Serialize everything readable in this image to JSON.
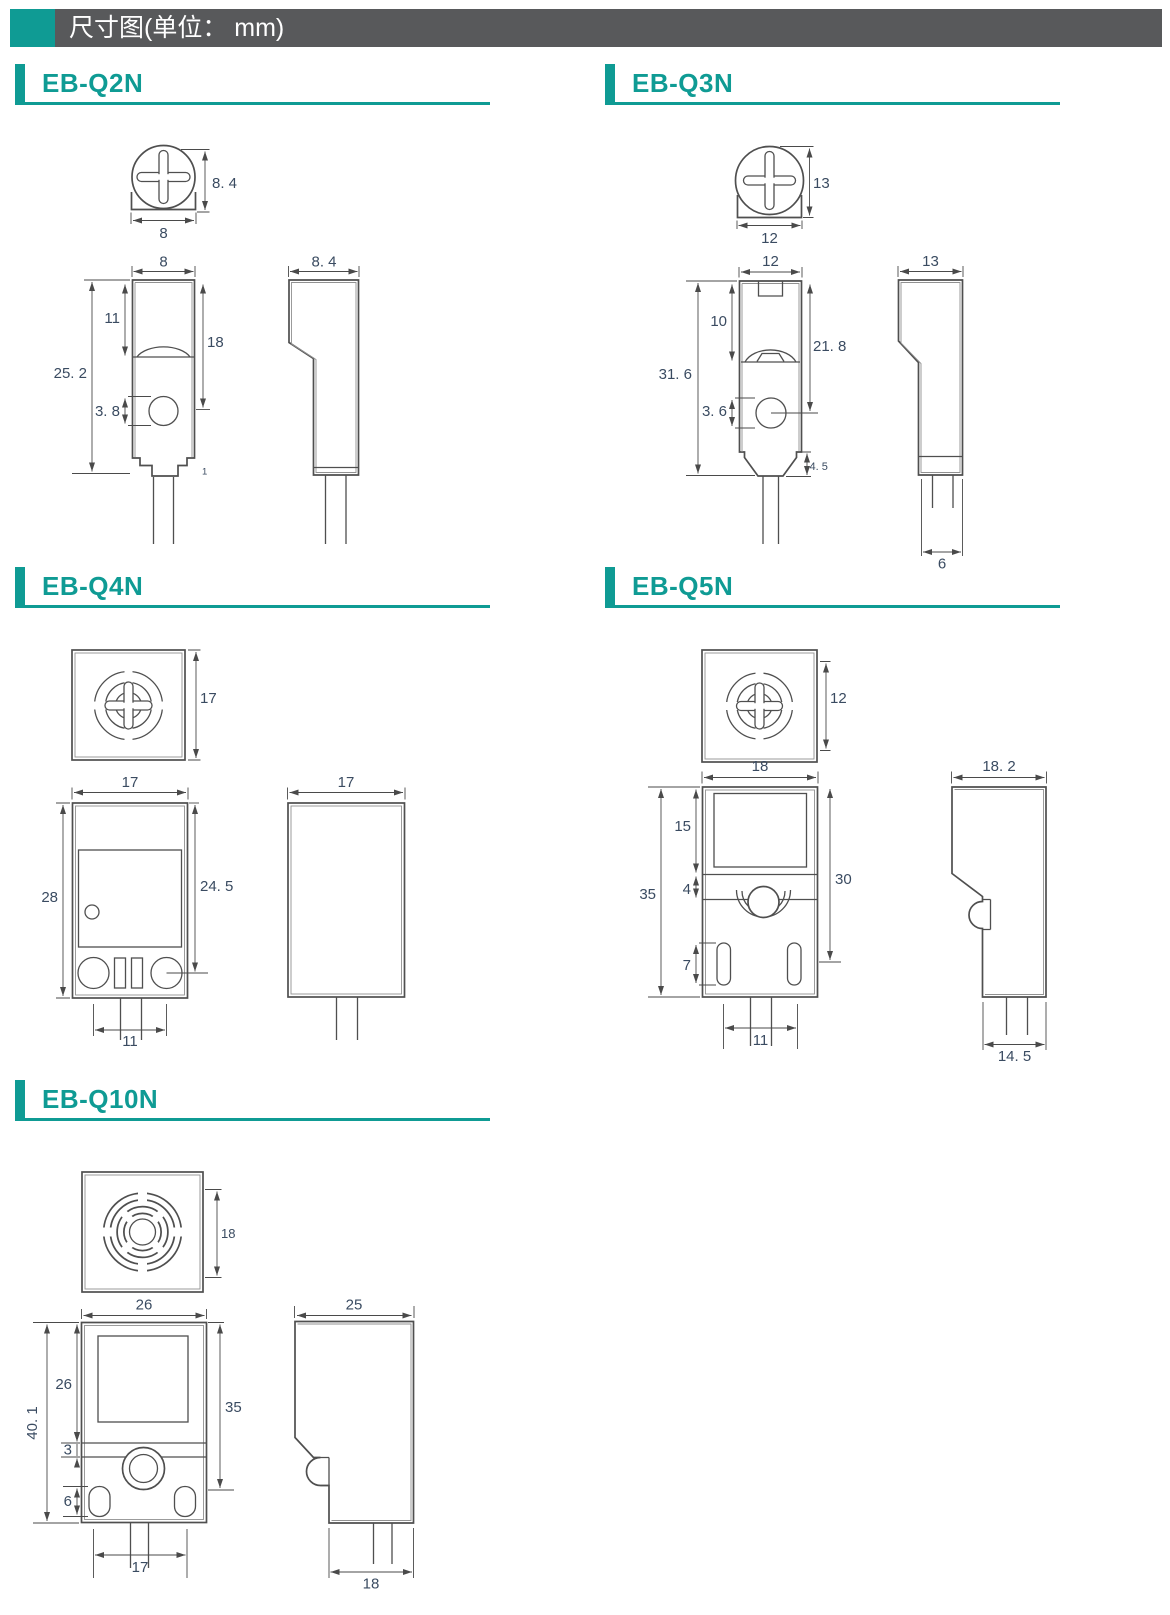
{
  "page": {
    "title": "尺寸图(单位： mm)"
  },
  "colors": {
    "accent_teal": "#0f9b94",
    "header_bar_gray": "#58595b",
    "dimension_text": "#3a4b61"
  },
  "sections": {
    "q2n": {
      "label": "EB-Q2N",
      "top": {
        "w": "8",
        "h": "8. 4"
      },
      "front": {
        "w": "8",
        "total": "25. 2",
        "upper": "11",
        "mid": "18",
        "lower": "3. 8",
        "step": "1"
      },
      "side": {
        "w": "8. 4"
      }
    },
    "q3n": {
      "label": "EB-Q3N",
      "top": {
        "w": "12",
        "h": "13"
      },
      "front": {
        "w": "12",
        "total": "31. 6",
        "upper": "10",
        "mid": "21. 8",
        "lower": "3. 6",
        "step": "4. 5"
      },
      "side": {
        "w": "13",
        "bottom": "6"
      }
    },
    "q4n": {
      "label": "EB-Q4N",
      "top": {
        "h": "17"
      },
      "front": {
        "w": "17",
        "total": "28",
        "inner": "24. 5",
        "bottom": "11"
      },
      "side": {
        "w": "17"
      }
    },
    "q5n": {
      "label": "EB-Q5N",
      "top": {
        "h": "12"
      },
      "front": {
        "w": "18",
        "total": "35",
        "upper": "15",
        "gap": "4",
        "slot": "7",
        "right": "30",
        "bottom": "11"
      },
      "side": {
        "w": "18. 2",
        "bottom": "14. 5"
      }
    },
    "q10n": {
      "label": "EB-Q10N",
      "top": {
        "h": "18"
      },
      "front": {
        "w": "26",
        "total": "40. 1",
        "upper": "26",
        "gap": "3",
        "slot": "6",
        "right": "35",
        "bottom": "17"
      },
      "side": {
        "w": "25",
        "bottom": "18"
      }
    }
  }
}
